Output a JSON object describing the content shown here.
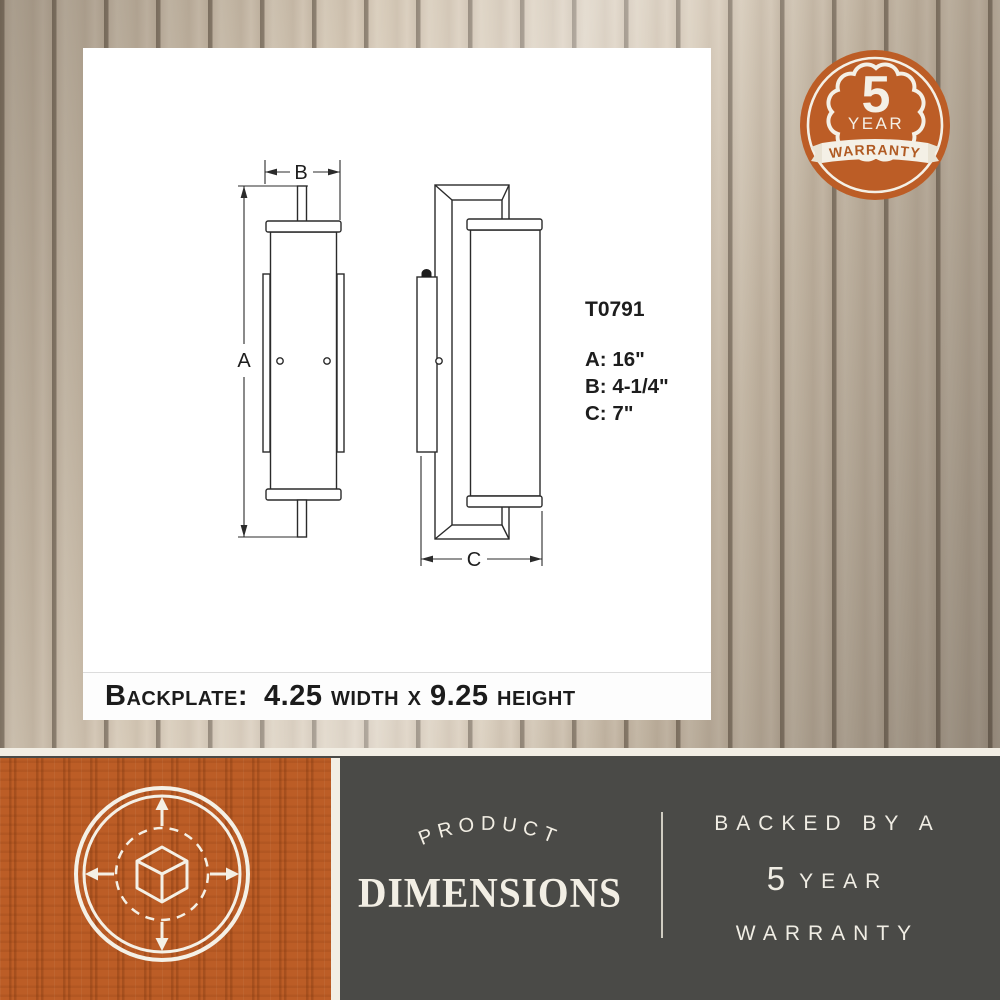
{
  "card": {
    "model": "T0791",
    "spec_a": "A: 16\"",
    "spec_b": "B: 4-1/4\"",
    "spec_c": "C: 7\"",
    "marker_a": "A",
    "marker_b": "B",
    "marker_c": "C",
    "backplate_label": "Backplate:",
    "backplate_value": "4.25 width x 9.25 height"
  },
  "badge": {
    "number": "5",
    "year_word": "YEAR",
    "warranty_word": "WARRANTY"
  },
  "bottom_bar": {
    "arc_label": "PRODUCT",
    "title": "DIMENSIONS",
    "backed_line": "BACKED BY A",
    "year_number": "5",
    "year_word": "YEAR",
    "warranty_word": "WARRANTY"
  },
  "icons": {
    "tile_icon": "cube-3d-measure-arrows-icon",
    "badge_icon": "warranty-seal-ribbon-icon"
  },
  "colors": {
    "orange": "#bc5d26",
    "footer_dark": "#4a4a47",
    "cream": "#f2eee4",
    "drawing_line": "#2b2b2b",
    "wood_plank": "#d2c5b2",
    "wood_gap": "#847767",
    "ribbon_text_orange": "#b05a22"
  }
}
